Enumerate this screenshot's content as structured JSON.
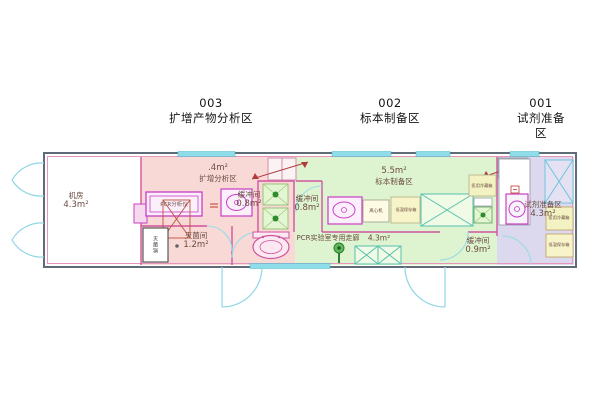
{
  "zone_titles": [
    {
      "code": "003",
      "name": "扩增产物分析区"
    },
    {
      "code": "002",
      "name": "标本制备区"
    },
    {
      "code": "001",
      "name": "试剂准备区"
    }
  ],
  "rooms": {
    "machine_room": {
      "name": "机房",
      "area": "4.3m²"
    },
    "amplification": {
      "area": ".4m²",
      "name": "扩增分析区"
    },
    "sterilization": {
      "name": "灭菌间",
      "area": "1.2m²"
    },
    "buffer_center": {
      "name": "缓冲间",
      "area": "0.8m²"
    },
    "buffer_specimen": {
      "name": "缓冲间",
      "area": "0.8m²"
    },
    "specimen": {
      "area": "5.5m²",
      "name": "标本制备区"
    },
    "corridor": {
      "name": "PCR实验室专用走廊",
      "area": "4.3m²"
    },
    "buffer_reagent": {
      "name": "缓冲间",
      "area": "0.9m²"
    },
    "reagent": {
      "name": "试剂准备区",
      "area": "4.3m²"
    }
  },
  "equipment": {
    "pcr_analyzer": "PCR分析仪",
    "autoclave": "灭菌锅",
    "centrifuge": "离心机",
    "freezer_specimen": "低温保存箱",
    "fridge_specimen": "医用冷藏箱",
    "fridge_reagent": "医用冷藏箱",
    "freezer_reagent": "低温保存箱"
  },
  "colors": {
    "zone_pink": "#f8d9d5",
    "zone_green": "#def3d0",
    "zone_lavender": "#dcd8ee",
    "window_cyan": "#8edde9",
    "wall_dark": "#5f6b76",
    "wall_magenta": "#d0549f",
    "equipment_magenta": "#c83fc3",
    "label_text": "#6b4b40",
    "vent_arrow_red": "#b03a3a",
    "pass_dot_green": "#2e8b2e",
    "cabinet_yellow": "#f2f0c4"
  }
}
